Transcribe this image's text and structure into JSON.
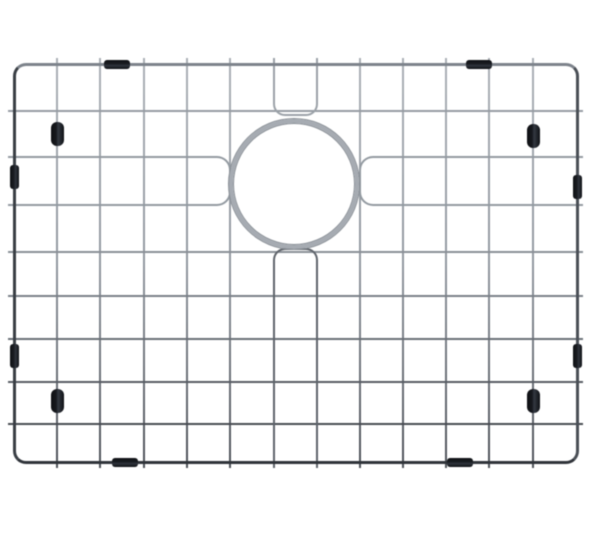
{
  "scene": {
    "description": "stainless-steel-sink-bottom-grid-product-photo",
    "background": "#ffffff",
    "canvas": {
      "width": 600,
      "height": 542
    },
    "frame": {
      "x": 14,
      "y": 64,
      "width": 563,
      "height": 398,
      "thickness": 3,
      "corner_radius": 13,
      "color_top": "#7d838b",
      "color_right": "#4a4f56",
      "color_bottom": "#30343a",
      "color_left": "#393e44"
    },
    "grid": {
      "vertical_x": [
        57,
        100,
        144,
        187,
        230,
        274,
        317,
        360,
        403,
        446,
        489,
        533
      ],
      "horizontal_y": [
        111,
        157,
        205,
        252,
        296,
        339,
        382,
        424
      ],
      "wire_thickness": 2,
      "stub_overhang": 6,
      "cut_columns_x": [
        274,
        317
      ],
      "cut_rows_y": [
        157,
        205
      ],
      "vertical_gradient": [
        "#abb0b6",
        "#9298a0",
        "#4d5158"
      ],
      "row_colors": [
        "#969ca3",
        "#949aa1",
        "#90979e",
        "#8a9097",
        "#7b8188",
        "#6a7077",
        "#585d64",
        "#484c52"
      ],
      "u_bend_top_color": "#9ba1a8",
      "u_bend_bottom_color": "#5f646b",
      "staple_color": "#939aa1",
      "bend_radius": 12
    },
    "drain_ring": {
      "cx": 294,
      "cy": 184,
      "outer_radius": 65,
      "thickness": 4.5,
      "color": "#a6abb2",
      "edge_color": "#878d94"
    },
    "feet": {
      "width": 13,
      "height": 24,
      "color": "#17191e",
      "positions": [
        {
          "x": 57,
          "y": 134
        },
        {
          "x": 533,
          "y": 136
        },
        {
          "x": 57,
          "y": 401
        },
        {
          "x": 533,
          "y": 401
        }
      ]
    },
    "frame_bumpers": {
      "color": "#1a1d22",
      "horizontal": {
        "w": 26,
        "h": 9
      },
      "vertical": {
        "w": 9,
        "h": 24
      },
      "top_x": [
        117,
        479
      ],
      "bottom_x": [
        125,
        460
      ],
      "left_y": [
        177,
        356
      ],
      "right_y": [
        187,
        356
      ]
    }
  }
}
